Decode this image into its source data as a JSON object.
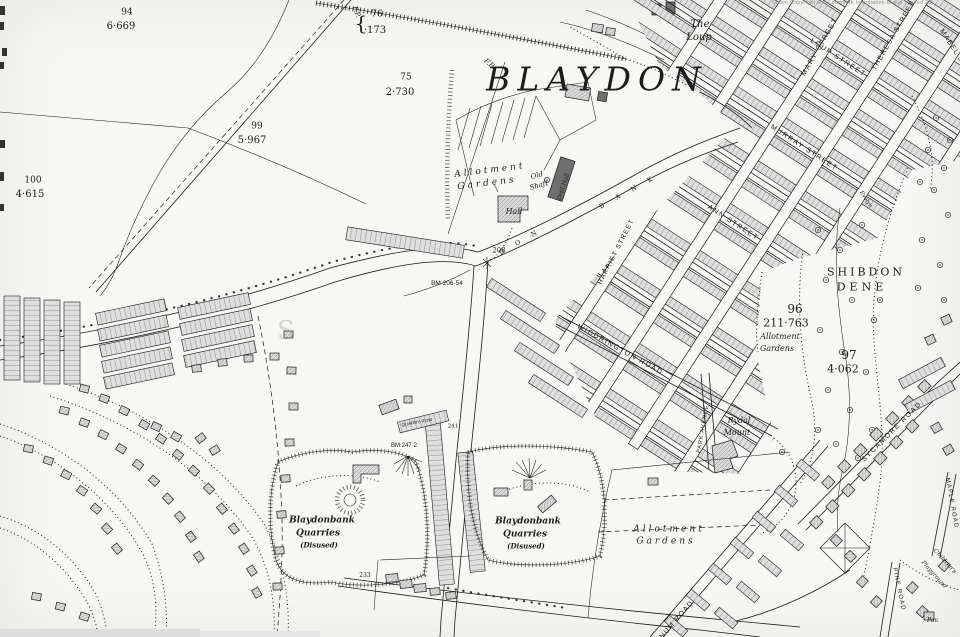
{
  "labels": {
    "title": "BLAYDON",
    "copyright": "Crown Copyright and Landmark Information Group Limited 20",
    "the_loup_1": "The",
    "the_loup_2": "Loup",
    "shibdon_1": "SHIBDON",
    "shibdon_2": "DENE",
    "fp": "F.P.",
    "brace": "{",
    "hall": "Hall",
    "drill_hall": "Drill Hall",
    "old_shaft_1": "Old",
    "old_shaft_2": "Shaft",
    "rydal_1": "Rydal",
    "rydal_2": "Mount",
    "quarry_1": "Blaydonbank",
    "quarry_2": "Quarries",
    "quarry_3": "(Disused)",
    "allotment_1": "Allotment",
    "allotment_2": "Gardens",
    "quarry_row": "QUARRY ROW",
    "pavilion": "Pav.",
    "playground_1": "Children's",
    "playground_2": "Playground",
    "watermark": "S"
  },
  "streets": {
    "mary": "MARY STREET",
    "loup": "LOUP STREET",
    "theresa": "THERESA STREET",
    "mabel": "MABEL STREET",
    "murray": "MURRAY STREET",
    "ann": "ANN STREET",
    "harriet": "HARRIET STREET",
    "widdrington": "WIDDRINGTON ROAD",
    "park": "PARK AVENUE",
    "sycamore": "SYCAMORE ROAD",
    "pine": "PINE ROAD",
    "maple": "MAPLE ROAD",
    "laburnum": "LABURNUM ROAD",
    "evelyn": "Evelyn",
    "blaydon_bank_letters": [
      "D",
      "O",
      "N",
      "B",
      "A",
      "N",
      "K"
    ]
  },
  "parcels": [
    {
      "number": "94",
      "area": "6·669"
    },
    {
      "number": "75",
      "area": "2·730"
    },
    {
      "number": "76",
      "area": "·173"
    },
    {
      "number": "99",
      "area": "5·967"
    },
    {
      "number": "100",
      "area": "4·615"
    },
    {
      "number": "96",
      "area": "211·763"
    },
    {
      "number": "97",
      "area": "4·062"
    }
  ],
  "spot_heights": [
    "208",
    "233",
    "241"
  ],
  "bench_marks": [
    "BM 206·54",
    "BM 247·2"
  ],
  "colors": {
    "paper": "#f7f7f4",
    "ink": "#1c1c1c",
    "building_fill": "#d8d8d8",
    "faint_text": "#8a8a8a"
  }
}
